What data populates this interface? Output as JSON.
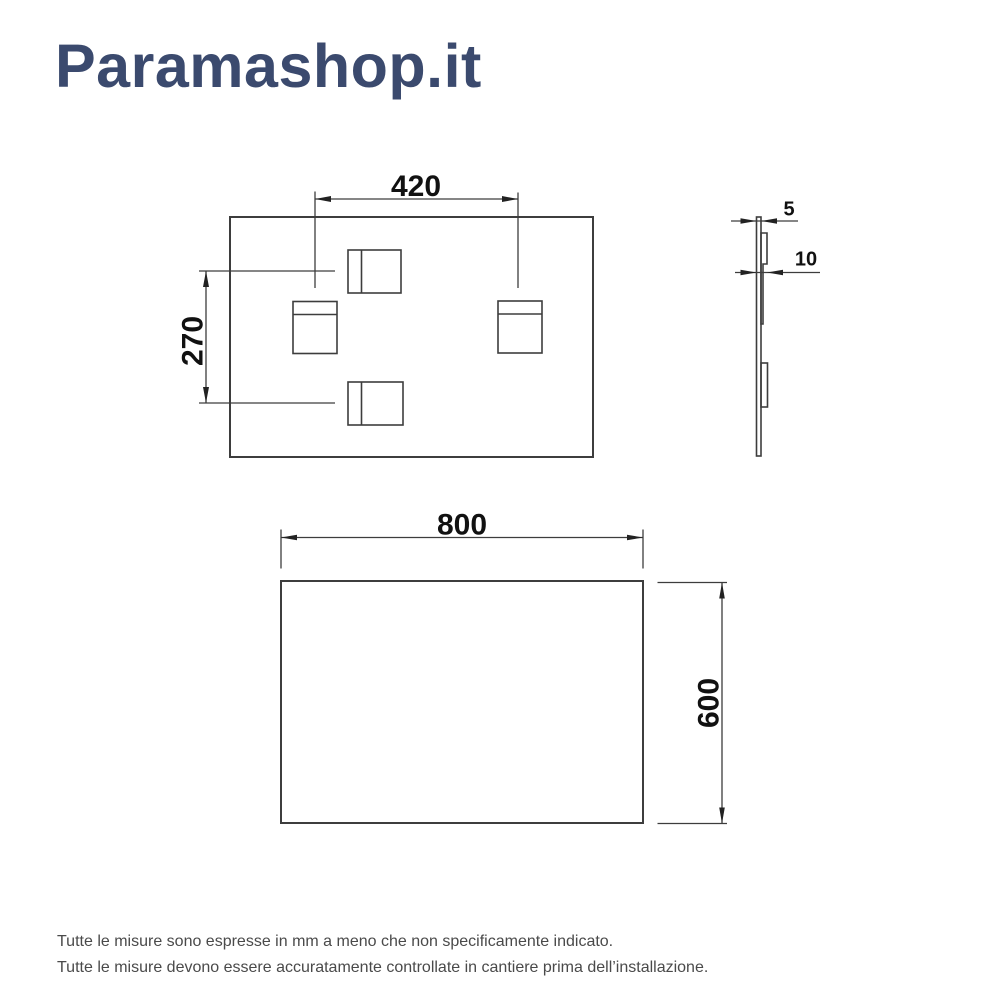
{
  "brand": {
    "logo_text": "Paramashop.it",
    "logo_color": "#3b4a6e"
  },
  "diagram": {
    "line_color": "#3d3d3d",
    "dim_text_color": "#111111",
    "rear_view": {
      "description": "rear view of panel with four mounting brackets",
      "dim_bracket_spacing_horizontal": "420",
      "dim_bracket_spacing_vertical": "270"
    },
    "side_view": {
      "description": "side profile of panel with brackets",
      "dim_panel_thickness": "5",
      "dim_total_depth": "10"
    },
    "front_view": {
      "description": "front view of panel",
      "dim_width": "800",
      "dim_height": "600"
    }
  },
  "footer": {
    "line1": "Tutte le misure sono espresse in mm a meno che non specificamente indicato.",
    "line2": "Tutte le misure devono essere accuratamente controllate in cantiere prima dell’installazione."
  }
}
